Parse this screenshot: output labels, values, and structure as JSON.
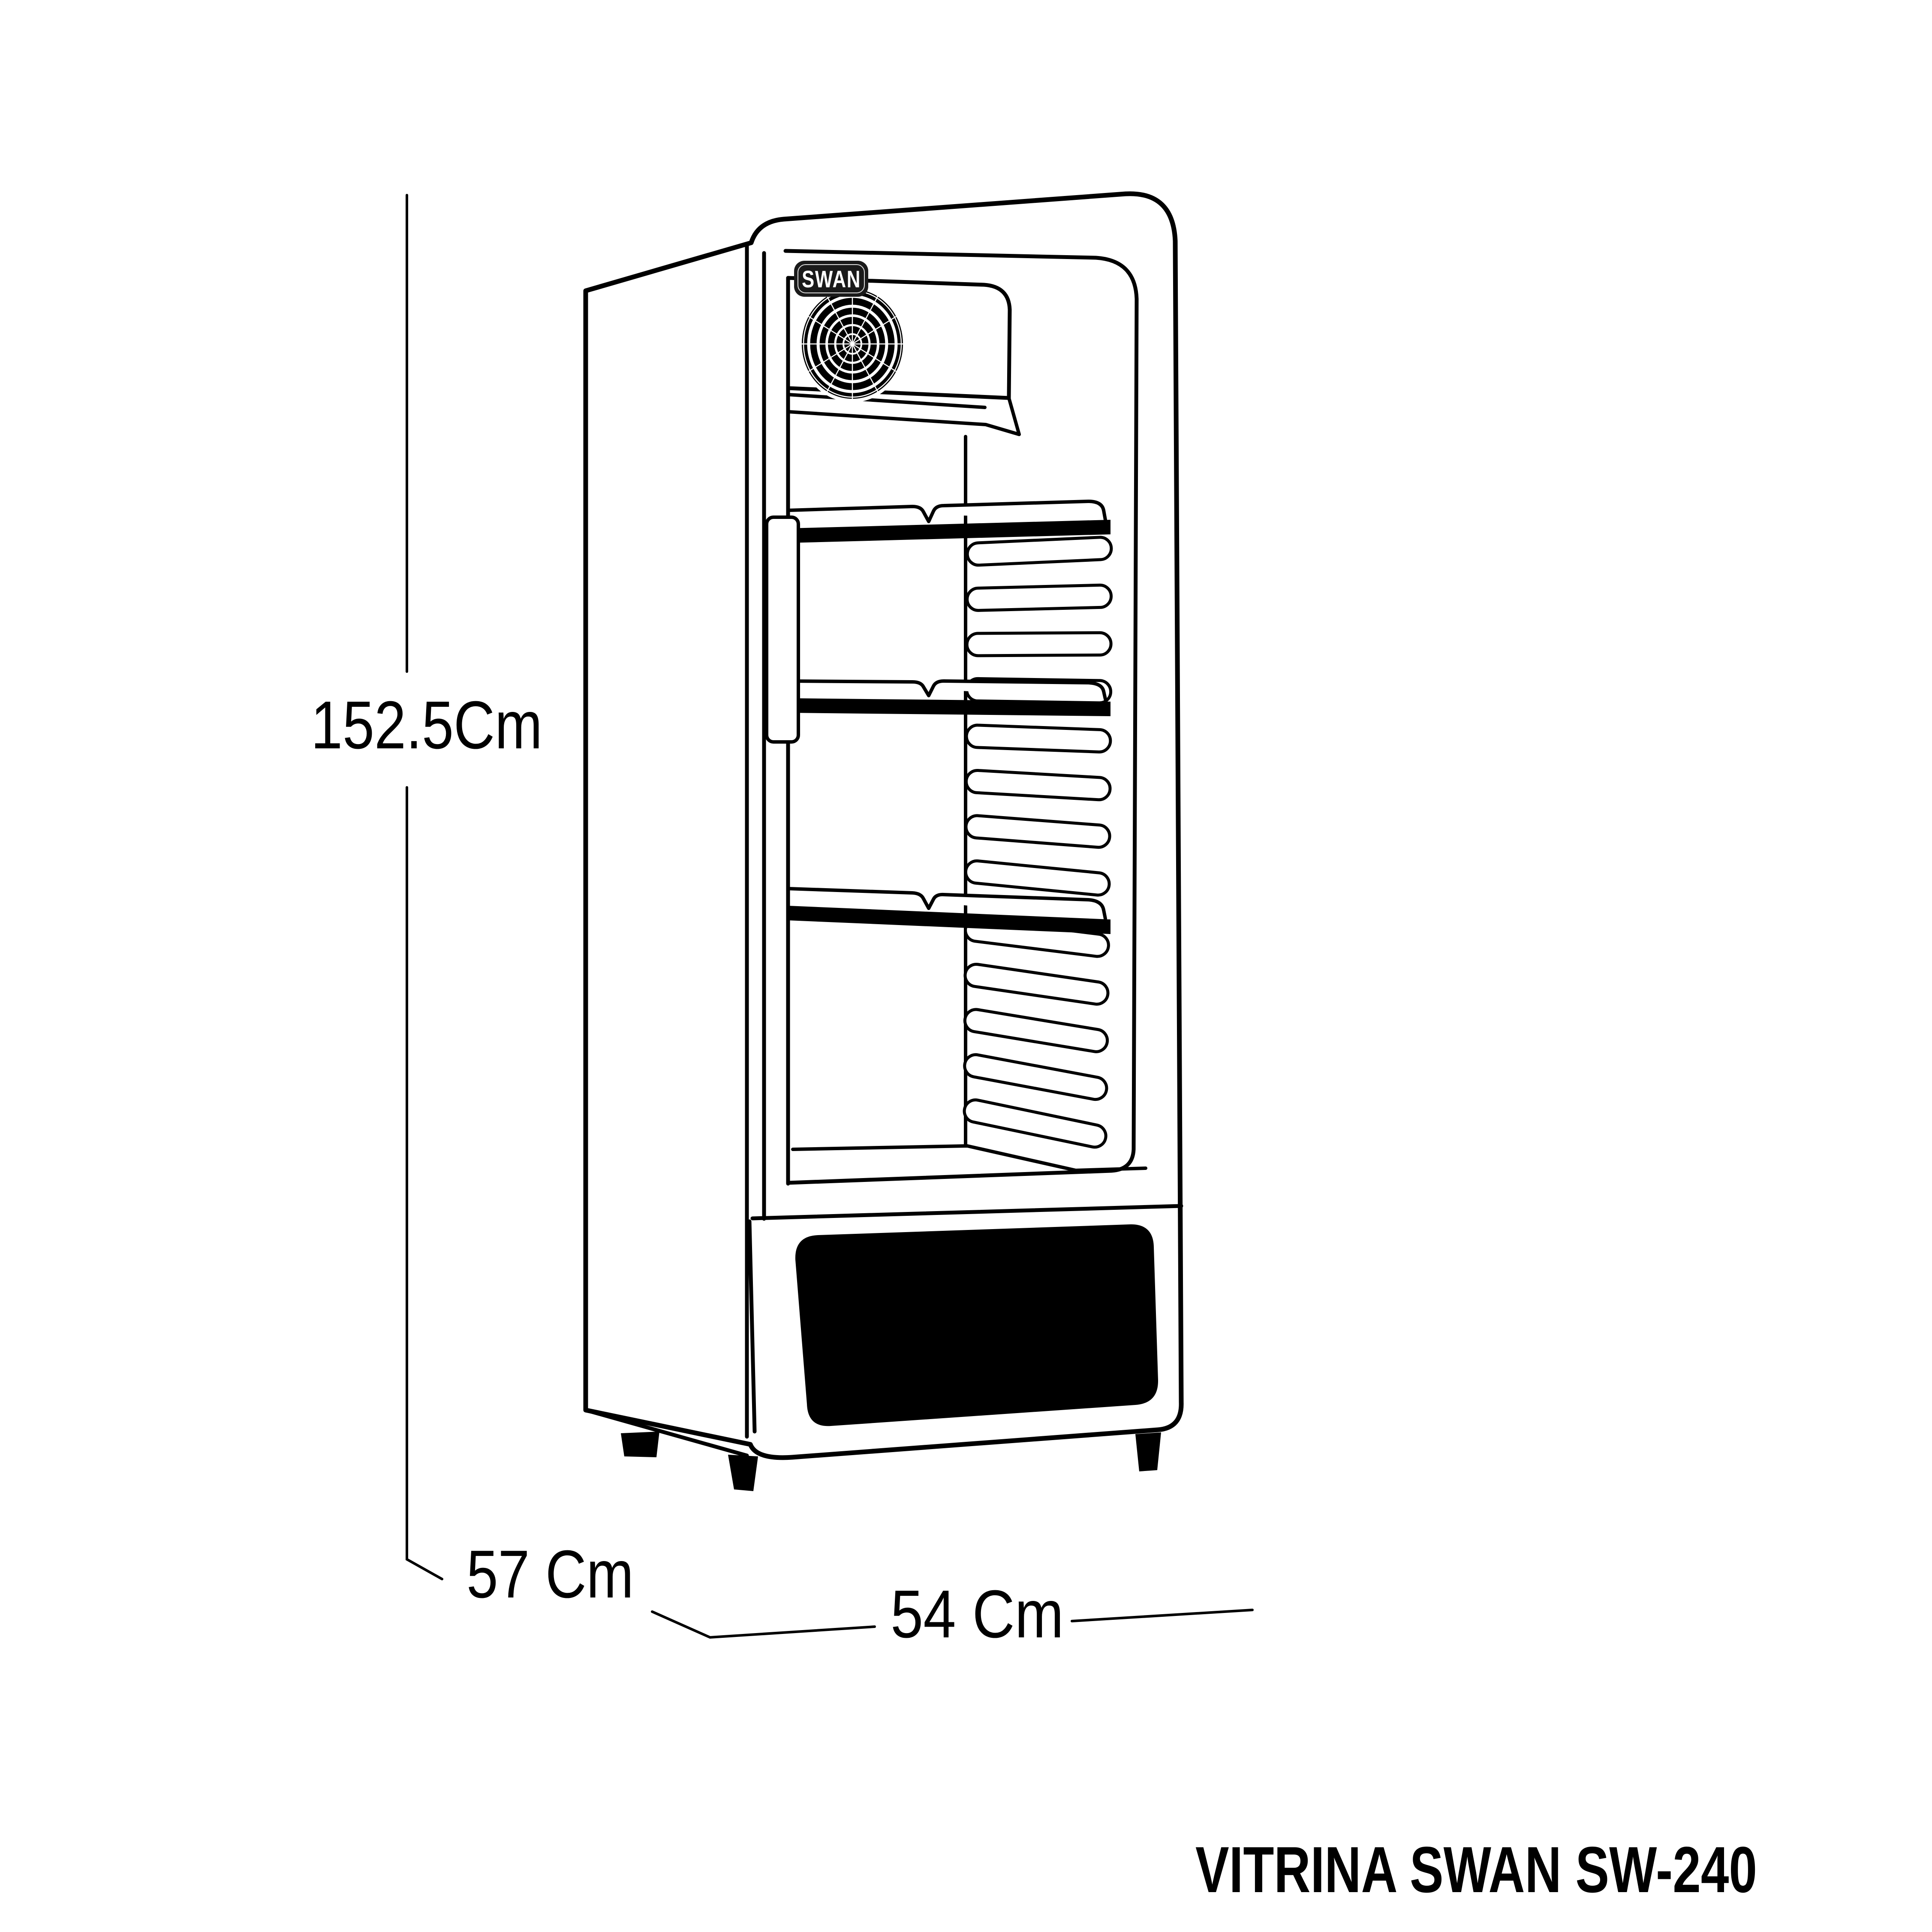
{
  "diagram": {
    "product_title": "VITRINA SWAN SW-240",
    "brand": "SWAN",
    "dimensions": {
      "height": "152.5Cm",
      "depth": "57 Cm",
      "width": "54 Cm"
    },
    "colors": {
      "line": "#000000",
      "background": "#ffffff",
      "badge_background": "#1a1a1a",
      "kick_panel": "#000000"
    }
  }
}
